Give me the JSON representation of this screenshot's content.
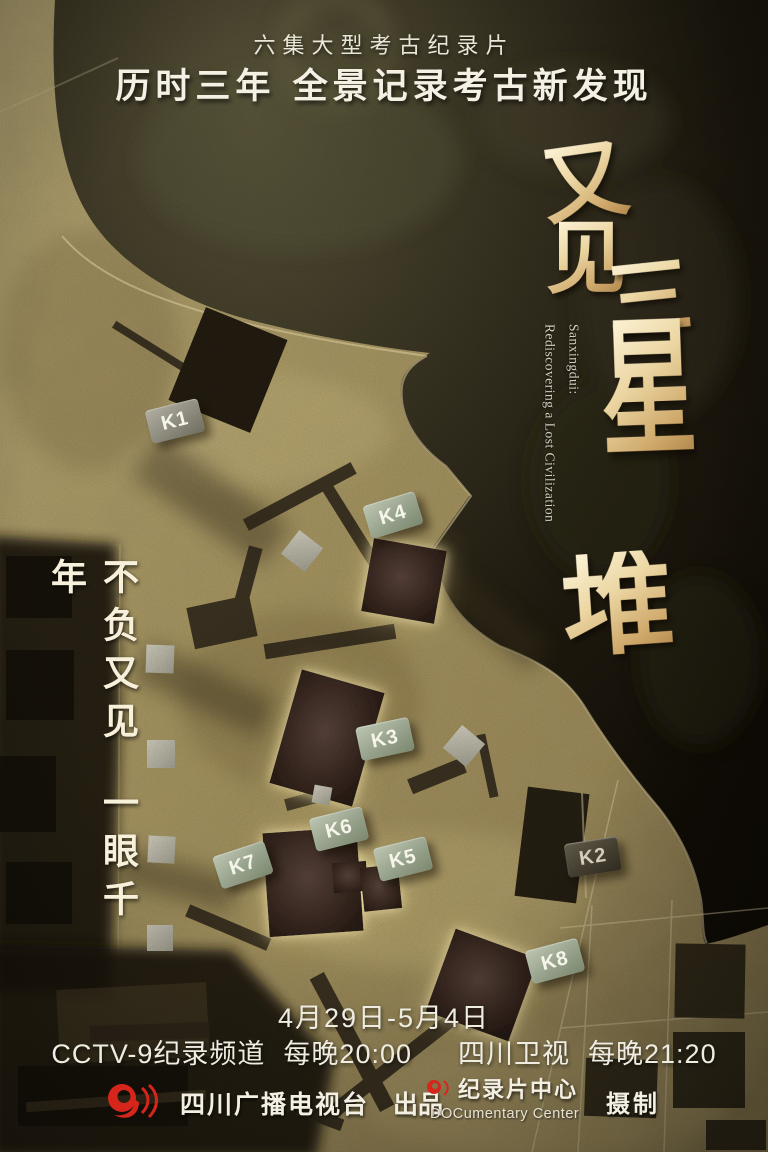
{
  "poster": {
    "series_tag": "六集大型考古纪录片",
    "slogan": "历时三年  全景记录考古新发现",
    "title_chars": [
      "又",
      "见",
      "三",
      "星",
      "堆"
    ],
    "title_en_line1": "Sanxingdui:",
    "title_en_line2": "Rediscovering a Lost Civilization",
    "left_slogan_line1": "不负又见",
    "left_slogan_line2": "一眼千年",
    "schedule": {
      "dates": "4月29日-5月4日",
      "channel_1": "CCTV-9纪录频道",
      "channel_1_time": "每晚20:00",
      "channel_2": "四川卫视",
      "channel_2_time": "每晚21:20"
    },
    "credits": {
      "producer_name": "四川广播电视台",
      "producer_role": "出品",
      "studio_name": "纪录片中心",
      "studio_sub": "DOCumentary Center",
      "studio_role": "摄制"
    },
    "colors": {
      "accent_red": "#d6251b",
      "gold": "#e5cf9c",
      "site_tan": "#a4935f"
    }
  },
  "pit_labels": {
    "k1": "K1",
    "k2": "K2",
    "k3": "K3",
    "k4": "K4",
    "k5": "K5",
    "k6": "K6",
    "k7": "K7",
    "k8": "K8"
  }
}
